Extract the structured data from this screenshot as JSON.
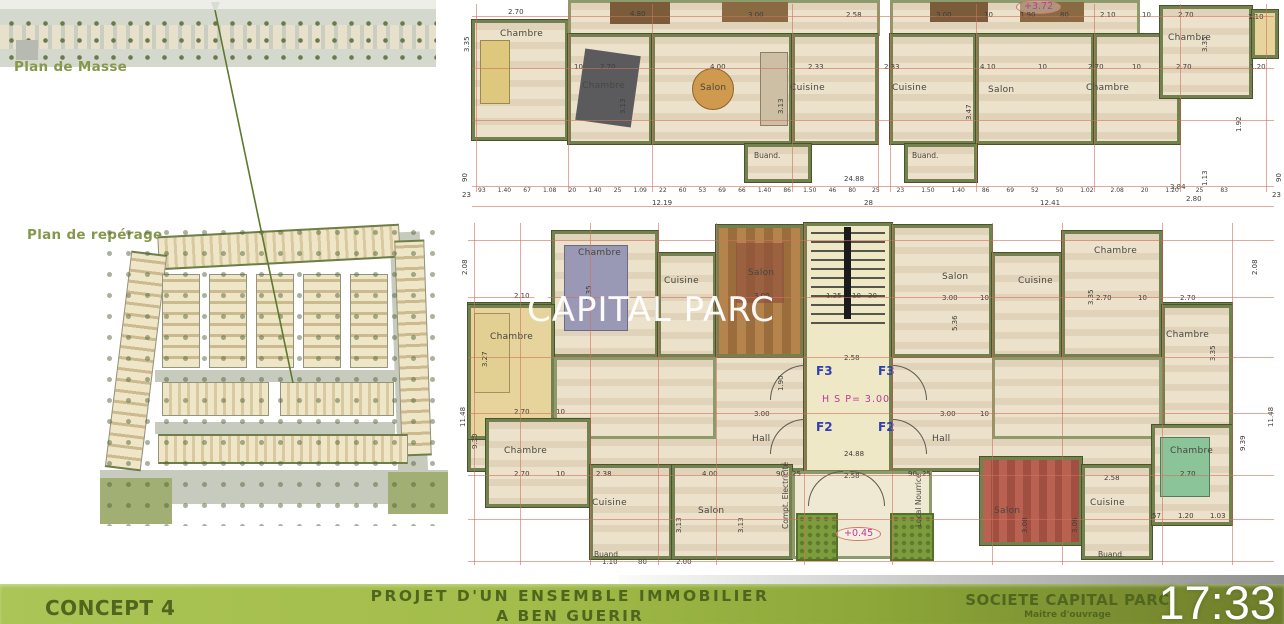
{
  "clock": "17:33",
  "watermark": "CAPITAL PARC",
  "left_panel": {
    "masse_label": "Plan de Masse",
    "reperage_label": "Plan de repérage"
  },
  "footer": {
    "concept": "CONCEPT 4",
    "project_line1": "PROJET D'UN ENSEMBLE IMMOBILIER",
    "project_line2": "A BEN GUERIR",
    "company": "SOCIETE CAPITAL PARC",
    "company_sub": "Maitre d'ouvrage"
  },
  "colors": {
    "footer_green": "#a7c050",
    "footer_dark_green": "#6e7d2b",
    "footer_text": "#50661f",
    "wall_green": "#72814e",
    "dimension_red": "#d2705c",
    "unit_blue": "#2f3fae",
    "level_magenta": "#c0399c",
    "watermark_white": "#ffffff"
  },
  "upper_plan": {
    "labels": [
      {
        "t": "Chambre",
        "x": 40,
        "y": 30,
        "c": "rm"
      },
      {
        "t": "Chambre",
        "x": 122,
        "y": 82,
        "c": "rm"
      },
      {
        "t": "Salon",
        "x": 240,
        "y": 84,
        "c": "rm"
      },
      {
        "t": "Cuisine",
        "x": 330,
        "y": 84,
        "c": "rm"
      },
      {
        "t": "Buand.",
        "x": 294,
        "y": 152,
        "c": "rm2"
      },
      {
        "t": "Cuisine",
        "x": 432,
        "y": 84,
        "c": "rm"
      },
      {
        "t": "Salon",
        "x": 528,
        "y": 86,
        "c": "rm"
      },
      {
        "t": "Chambre",
        "x": 626,
        "y": 84,
        "c": "rm"
      },
      {
        "t": "Chambre",
        "x": 708,
        "y": 34,
        "c": "rm"
      },
      {
        "t": "Buand.",
        "x": 452,
        "y": 152,
        "c": "rm2"
      },
      {
        "t": "+3.72",
        "x": 556,
        "y": 0,
        "c": "oval"
      },
      {
        "t": "2.70",
        "x": 48,
        "y": 9
      },
      {
        "t": "4.80",
        "x": 170,
        "y": 11
      },
      {
        "t": "3.00",
        "x": 288,
        "y": 12
      },
      {
        "t": "2.58",
        "x": 386,
        "y": 12
      },
      {
        "t": "3.00",
        "x": 476,
        "y": 12
      },
      {
        "t": "10",
        "x": 524,
        "y": 12
      },
      {
        "t": "1.90",
        "x": 560,
        "y": 12
      },
      {
        "t": "80",
        "x": 600,
        "y": 12
      },
      {
        "t": "2.10",
        "x": 640,
        "y": 12
      },
      {
        "t": "10",
        "x": 682,
        "y": 12
      },
      {
        "t": "2.70",
        "x": 718,
        "y": 12
      },
      {
        "t": "1.10",
        "x": 788,
        "y": 14
      },
      {
        "t": "10",
        "x": 114,
        "y": 64
      },
      {
        "t": "2.70",
        "x": 140,
        "y": 64
      },
      {
        "t": "4.00",
        "x": 250,
        "y": 64
      },
      {
        "t": "2.33",
        "x": 348,
        "y": 64
      },
      {
        "t": "2.33",
        "x": 424,
        "y": 64
      },
      {
        "t": "4.10",
        "x": 520,
        "y": 64
      },
      {
        "t": "10",
        "x": 578,
        "y": 64
      },
      {
        "t": "2.70",
        "x": 628,
        "y": 64
      },
      {
        "t": "10",
        "x": 672,
        "y": 64
      },
      {
        "t": "2.70",
        "x": 716,
        "y": 64
      },
      {
        "t": "1.20",
        "x": 790,
        "y": 64
      },
      {
        "t": "3.35",
        "x": 4,
        "y": 52,
        "r": 1
      },
      {
        "t": "3.13",
        "x": 160,
        "y": 114,
        "r": 1
      },
      {
        "t": "3.13",
        "x": 318,
        "y": 114,
        "r": 1
      },
      {
        "t": "3.47",
        "x": 506,
        "y": 120,
        "r": 1
      },
      {
        "t": "3.35",
        "x": 742,
        "y": 52,
        "r": 1
      },
      {
        "t": "1.92",
        "x": 776,
        "y": 132,
        "r": 1
      },
      {
        "t": "1.13",
        "x": 742,
        "y": 186,
        "r": 1
      },
      {
        "t": "90",
        "x": 2,
        "y": 182,
        "r": 1
      },
      {
        "t": "23",
        "x": 2,
        "y": 192
      },
      {
        "t": "90",
        "x": 816,
        "y": 182,
        "r": 1
      },
      {
        "t": "23",
        "x": 812,
        "y": 192
      },
      {
        "t": "24.88",
        "x": 384,
        "y": 176
      },
      {
        "t": "28",
        "x": 404,
        "y": 200
      },
      {
        "t": "12.19",
        "x": 192,
        "y": 200
      },
      {
        "t": "12.41",
        "x": 580,
        "y": 200
      },
      {
        "t": "3.84",
        "x": 710,
        "y": 184
      },
      {
        "t": "2.80",
        "x": 726,
        "y": 196
      }
    ],
    "chains": [
      {
        "x": 18,
        "y": 188,
        "w": 378,
        "items": [
          "93",
          "1.40",
          "67",
          "1.08",
          "20",
          "1.40",
          "25",
          "1.09",
          "22",
          "60",
          "53",
          "69",
          "66",
          "1.40",
          "86",
          "1.50",
          "46",
          "80"
        ]
      },
      {
        "x": 412,
        "y": 188,
        "w": 356,
        "items": [
          "25",
          "23",
          "1.50",
          "1.40",
          "86",
          "69",
          "52",
          "50",
          "1.02",
          "2.08",
          "20",
          "1.20",
          "25",
          "83"
        ]
      }
    ]
  },
  "lower_plan": {
    "labels": [
      {
        "t": "Chambre",
        "x": 118,
        "y": 36,
        "c": "rm"
      },
      {
        "t": "Cuisine",
        "x": 204,
        "y": 64,
        "c": "rm"
      },
      {
        "t": "Salon",
        "x": 288,
        "y": 56,
        "c": "rm"
      },
      {
        "t": "Chambre",
        "x": 30,
        "y": 120,
        "c": "rm"
      },
      {
        "t": "Salon",
        "x": 482,
        "y": 60,
        "c": "rm"
      },
      {
        "t": "Cuisine",
        "x": 558,
        "y": 64,
        "c": "rm"
      },
      {
        "t": "Chambre",
        "x": 634,
        "y": 34,
        "c": "rm"
      },
      {
        "t": "Chambre",
        "x": 706,
        "y": 118,
        "c": "rm"
      },
      {
        "t": "Hall",
        "x": 292,
        "y": 222,
        "c": "rm"
      },
      {
        "t": "Hall",
        "x": 472,
        "y": 222,
        "c": "rm"
      },
      {
        "t": "Chambre",
        "x": 44,
        "y": 234,
        "c": "rm"
      },
      {
        "t": "Cuisine",
        "x": 132,
        "y": 286,
        "c": "rm"
      },
      {
        "t": "Buand.",
        "x": 134,
        "y": 338,
        "c": "rm2"
      },
      {
        "t": "Salon",
        "x": 238,
        "y": 294,
        "c": "rm"
      },
      {
        "t": "Salon",
        "x": 534,
        "y": 294,
        "c": "rm"
      },
      {
        "t": "Cuisine",
        "x": 630,
        "y": 286,
        "c": "rm"
      },
      {
        "t": "Buand.",
        "x": 638,
        "y": 338,
        "c": "rm2"
      },
      {
        "t": "Chambre",
        "x": 710,
        "y": 234,
        "c": "rm"
      },
      {
        "t": "Compt. Electricité",
        "x": 322,
        "y": 316,
        "r": 1,
        "c": "rm2"
      },
      {
        "t": "Local Nourrice",
        "x": 455,
        "y": 314,
        "r": 1,
        "c": "rm2"
      },
      {
        "t": "F3",
        "x": 356,
        "y": 152,
        "c": "unit"
      },
      {
        "t": "F3",
        "x": 418,
        "y": 152,
        "c": "unit"
      },
      {
        "t": "F2",
        "x": 356,
        "y": 208,
        "c": "unit"
      },
      {
        "t": "F2",
        "x": 418,
        "y": 208,
        "c": "unit"
      },
      {
        "t": "H S P= 3.00",
        "x": 362,
        "y": 182,
        "c": "mag"
      },
      {
        "t": "+0.45",
        "x": 376,
        "y": 314,
        "c": "oval"
      },
      {
        "t": "24.88",
        "x": 384,
        "y": 238
      },
      {
        "t": "2.58",
        "x": 384,
        "y": 142
      },
      {
        "t": "2.10",
        "x": 54,
        "y": 80
      },
      {
        "t": "3.00",
        "x": 294,
        "y": 80
      },
      {
        "t": "1.25",
        "x": 366,
        "y": 80
      },
      {
        "t": "10",
        "x": 392,
        "y": 80
      },
      {
        "t": "20",
        "x": 408,
        "y": 80
      },
      {
        "t": "3.00",
        "x": 482,
        "y": 82
      },
      {
        "t": "10",
        "x": 520,
        "y": 82
      },
      {
        "t": "2.70",
        "x": 636,
        "y": 82
      },
      {
        "t": "10",
        "x": 678,
        "y": 82
      },
      {
        "t": "2.70",
        "x": 720,
        "y": 82
      },
      {
        "t": "2.70",
        "x": 54,
        "y": 196
      },
      {
        "t": "10",
        "x": 96,
        "y": 196
      },
      {
        "t": "3.00",
        "x": 294,
        "y": 198
      },
      {
        "t": "3.00",
        "x": 480,
        "y": 198
      },
      {
        "t": "10",
        "x": 520,
        "y": 198
      },
      {
        "t": "1.90",
        "x": 318,
        "y": 178,
        "r": 1
      },
      {
        "t": "2.70",
        "x": 54,
        "y": 258
      },
      {
        "t": "10",
        "x": 96,
        "y": 258
      },
      {
        "t": "2.38",
        "x": 136,
        "y": 258
      },
      {
        "t": "4.00",
        "x": 242,
        "y": 258
      },
      {
        "t": "90",
        "x": 316,
        "y": 258
      },
      {
        "t": "25",
        "x": 332,
        "y": 258
      },
      {
        "t": "2.58",
        "x": 384,
        "y": 260
      },
      {
        "t": "90",
        "x": 448,
        "y": 258
      },
      {
        "t": "25",
        "x": 462,
        "y": 258
      },
      {
        "t": "2.58",
        "x": 644,
        "y": 262
      },
      {
        "t": "2.70",
        "x": 720,
        "y": 258
      },
      {
        "t": "57",
        "x": 692,
        "y": 300
      },
      {
        "t": "1.20",
        "x": 718,
        "y": 300
      },
      {
        "t": "1.03",
        "x": 750,
        "y": 300
      },
      {
        "t": "1.10",
        "x": 142,
        "y": 346
      },
      {
        "t": "80",
        "x": 178,
        "y": 346
      },
      {
        "t": "2.00",
        "x": 216,
        "y": 346
      },
      {
        "t": "2.08",
        "x": 2,
        "y": 62,
        "r": 1
      },
      {
        "t": "11.48",
        "x": 0,
        "y": 214,
        "r": 1
      },
      {
        "t": "9.39",
        "x": 12,
        "y": 236,
        "r": 1
      },
      {
        "t": "2.08",
        "x": 792,
        "y": 62,
        "r": 1
      },
      {
        "t": "11.48",
        "x": 808,
        "y": 214,
        "r": 1
      },
      {
        "t": "9.39",
        "x": 780,
        "y": 238,
        "r": 1
      },
      {
        "t": "3.35",
        "x": 126,
        "y": 88,
        "r": 1
      },
      {
        "t": "5.36",
        "x": 492,
        "y": 118,
        "r": 1
      },
      {
        "t": "3.35",
        "x": 628,
        "y": 92,
        "r": 1
      },
      {
        "t": "3.35",
        "x": 750,
        "y": 148,
        "r": 1
      },
      {
        "t": "3.27",
        "x": 22,
        "y": 154,
        "r": 1
      },
      {
        "t": "3.13",
        "x": 216,
        "y": 320,
        "r": 1
      },
      {
        "t": "3.13",
        "x": 278,
        "y": 320,
        "r": 1
      },
      {
        "t": "3.08",
        "x": 562,
        "y": 320,
        "r": 1
      },
      {
        "t": "3.06",
        "x": 612,
        "y": 320,
        "r": 1
      }
    ]
  }
}
